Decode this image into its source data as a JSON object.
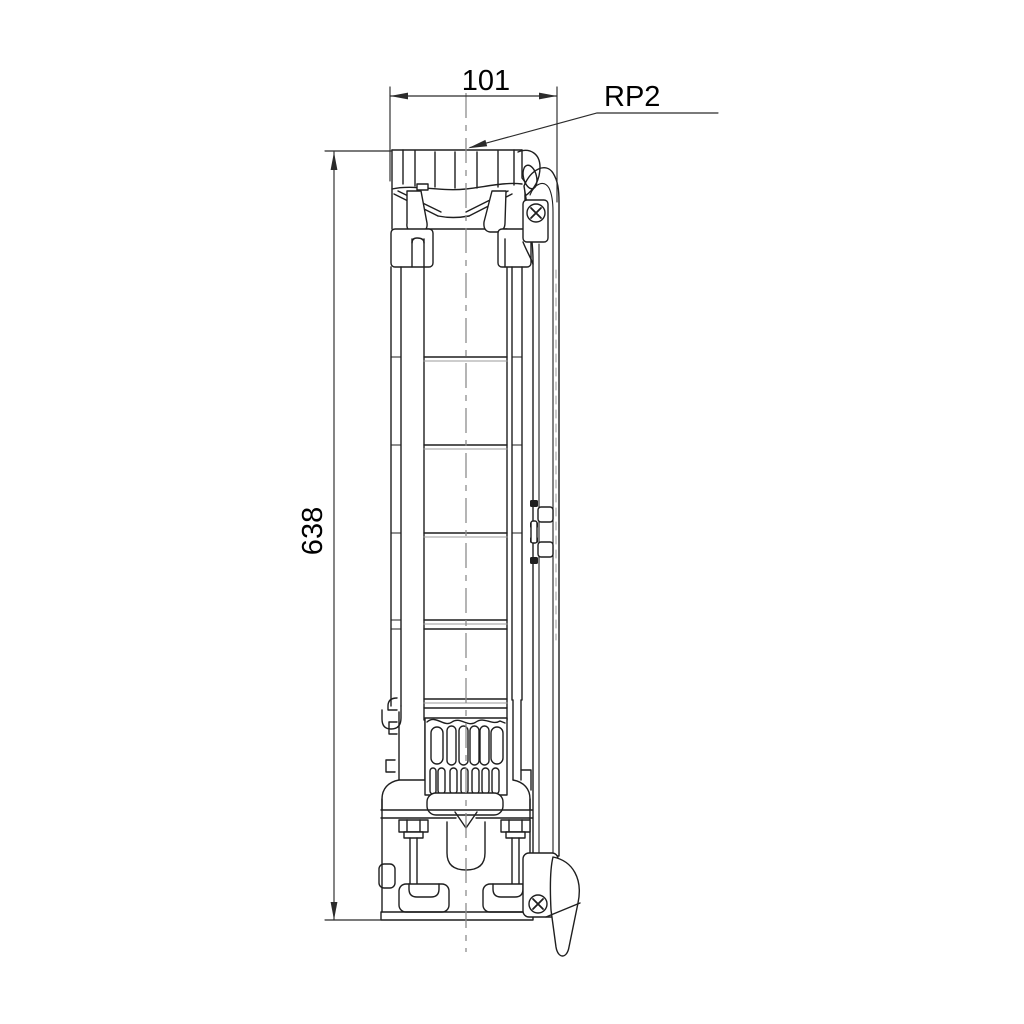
{
  "page": {
    "background_color": "#ffffff"
  },
  "drawing": {
    "description": "Dimensional outline drawing of a vertical submersible borehole pump",
    "line_color": "#1f1f1f",
    "light_line_color": "#9b9b9b",
    "centerline_color": "#8d8d8d",
    "dimension_color": "#2b2b2b",
    "annotations": {
      "width_dimension": "101",
      "height_dimension": "638",
      "thread_label": "RP2"
    }
  }
}
